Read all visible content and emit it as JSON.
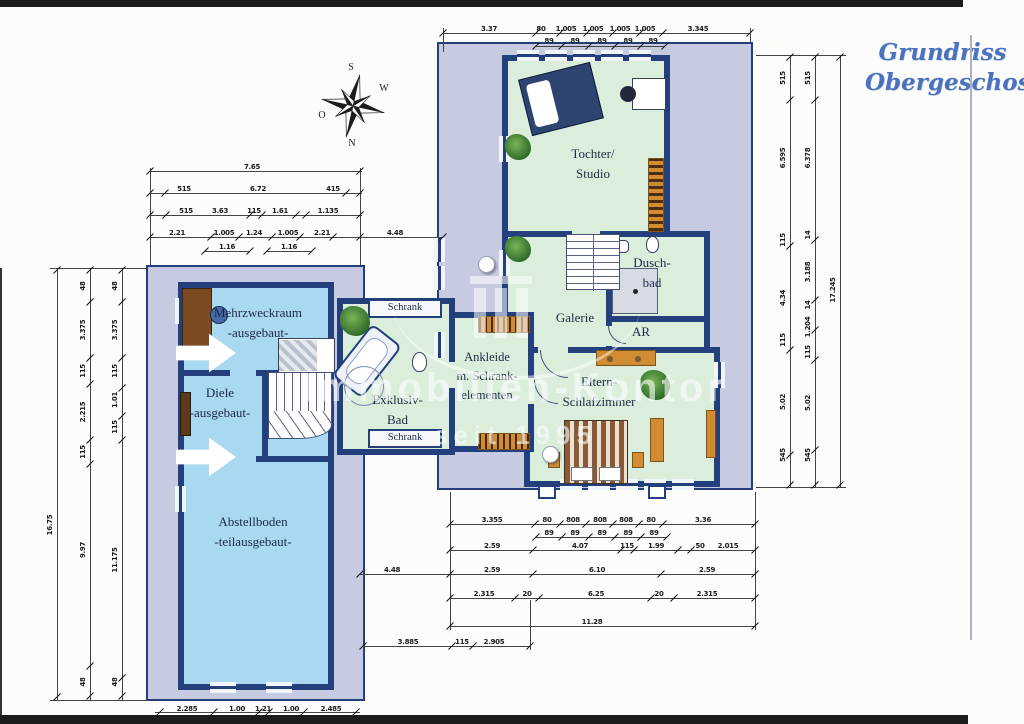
{
  "title": {
    "line1": "Grundriss",
    "line2": "Obergeschoss"
  },
  "watermark": {
    "main": "Immobilien-Kontor",
    "sub": "seit 1995"
  },
  "compass": {
    "top": "S",
    "right": "W",
    "left": "O",
    "bottom": "N"
  },
  "rooms": {
    "tochter": [
      "Tochter/",
      "Studio"
    ],
    "dusch": [
      "Dusch-",
      "bad"
    ],
    "galerie": "Galerie",
    "ar": "AR",
    "ankleide": [
      "Ankleide",
      "m. Schrank-",
      "elementen"
    ],
    "eltern": [
      "Eltern-",
      "Schlafzimmer"
    ],
    "schrank_top": "Schrank",
    "schrank_bottom": "Schrank",
    "exklusiv": [
      "Exklusiv-",
      "Bad"
    ],
    "mehrzweck": [
      "Mehrzweckraum",
      "-ausgebaut-"
    ],
    "diele": [
      "Diele",
      "-ausgebaut-"
    ],
    "abstell": [
      "Abstellboden",
      "-teilausgebaut-"
    ]
  },
  "dims": {
    "top1": [
      "3.37",
      "80",
      "1.005",
      "1.005",
      "1.005",
      "1.005",
      "3.345"
    ],
    "top2": [
      "89",
      "89",
      "89",
      "89",
      "89"
    ],
    "ul1": "7.65",
    "ul2": [
      "515",
      "6.72",
      "415"
    ],
    "ul3": [
      "515",
      "3.63",
      "115",
      "1.61",
      "1.135"
    ],
    "ul4": [
      "2.21",
      "1.005",
      "1.24",
      "1.005",
      "2.21",
      "4.48"
    ],
    "ul5": [
      "1.16",
      "1.16"
    ],
    "left_outer": "16.75",
    "left_mid": [
      "48",
      "3.375",
      "115",
      "2.215",
      "115",
      "9.97",
      "48"
    ],
    "left_inner": [
      "48",
      "3.375",
      "115",
      "1.01",
      "115",
      "11.175",
      "48"
    ],
    "right_inner": [
      "515",
      "6.595",
      "115",
      "4.34",
      "115",
      "5.02",
      "545"
    ],
    "right_mid": [
      "515",
      "6.378",
      "14",
      "3.188",
      "14",
      "1.204",
      "115",
      "5.02",
      "545"
    ],
    "right_outer": "17.245",
    "b1": [
      "3.355",
      "80",
      "808",
      "808",
      "808",
      "80",
      "3.36"
    ],
    "b2": [
      "89",
      "89",
      "89",
      "89",
      "89"
    ],
    "b3": [
      "2.59",
      "4.07",
      "115",
      "1.99",
      "50",
      "2.015"
    ],
    "b4": [
      "4.48",
      "2.59",
      "6.10",
      "2.59"
    ],
    "b5": [
      "2.315",
      "20",
      "6.25",
      "20",
      "2.315"
    ],
    "b6": "11.28",
    "b7": [
      "3.885",
      "115",
      "2.905"
    ],
    "b8": [
      "2.285",
      "1.00",
      "1.21",
      "1.00",
      "2.485"
    ]
  },
  "colors": {
    "wall_navy": "#23407c",
    "room_green": "#daeedb",
    "room_blue": "#a9d8f1",
    "roof_gray": "#c6cbe1",
    "furniture_orange": "#d18c33",
    "title_blue": "#4a72be"
  }
}
